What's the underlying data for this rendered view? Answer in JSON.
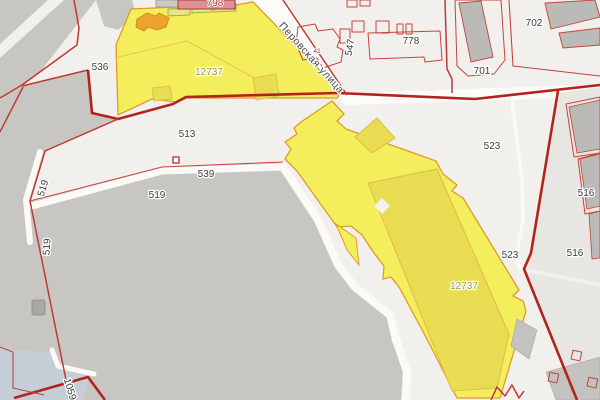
{
  "map": {
    "type": "cadastral-map",
    "street": {
      "name": "Перовская улица"
    },
    "selected_parcel": {
      "id": "12737"
    },
    "labels": {
      "street": "Перовская улица",
      "l798": "798",
      "l778": "778",
      "l702": "702",
      "l701": "701",
      "l547": "547",
      "l42": "42",
      "l536": "536",
      "l513": "513",
      "l539": "539",
      "l519h": "519",
      "l519r1": "519",
      "l519r2": "519",
      "l1059": "1059",
      "l523a": "523",
      "l523b": "523",
      "l516a": "516",
      "l516b": "516",
      "l12737a": "12737",
      "l12737b": "12737"
    },
    "colors": {
      "background": "#f2f0ec",
      "gray_area": "#c8c6c3",
      "light_zone": "#e8e6e3",
      "building_slab": "#bbbab7",
      "parcel_yellow": "#f5ee5c",
      "parcel_border": "#dd9b2a",
      "building_on_parcel": "#e9dc52",
      "building_orange": "#eda42f",
      "building_pink": "#dd9196",
      "boundary_red": "#b2231c",
      "water": "#c3ced6",
      "label_dark": "#3b3b3b",
      "label_olive": "#a39729",
      "road_white": "#fbfaf7"
    }
  }
}
